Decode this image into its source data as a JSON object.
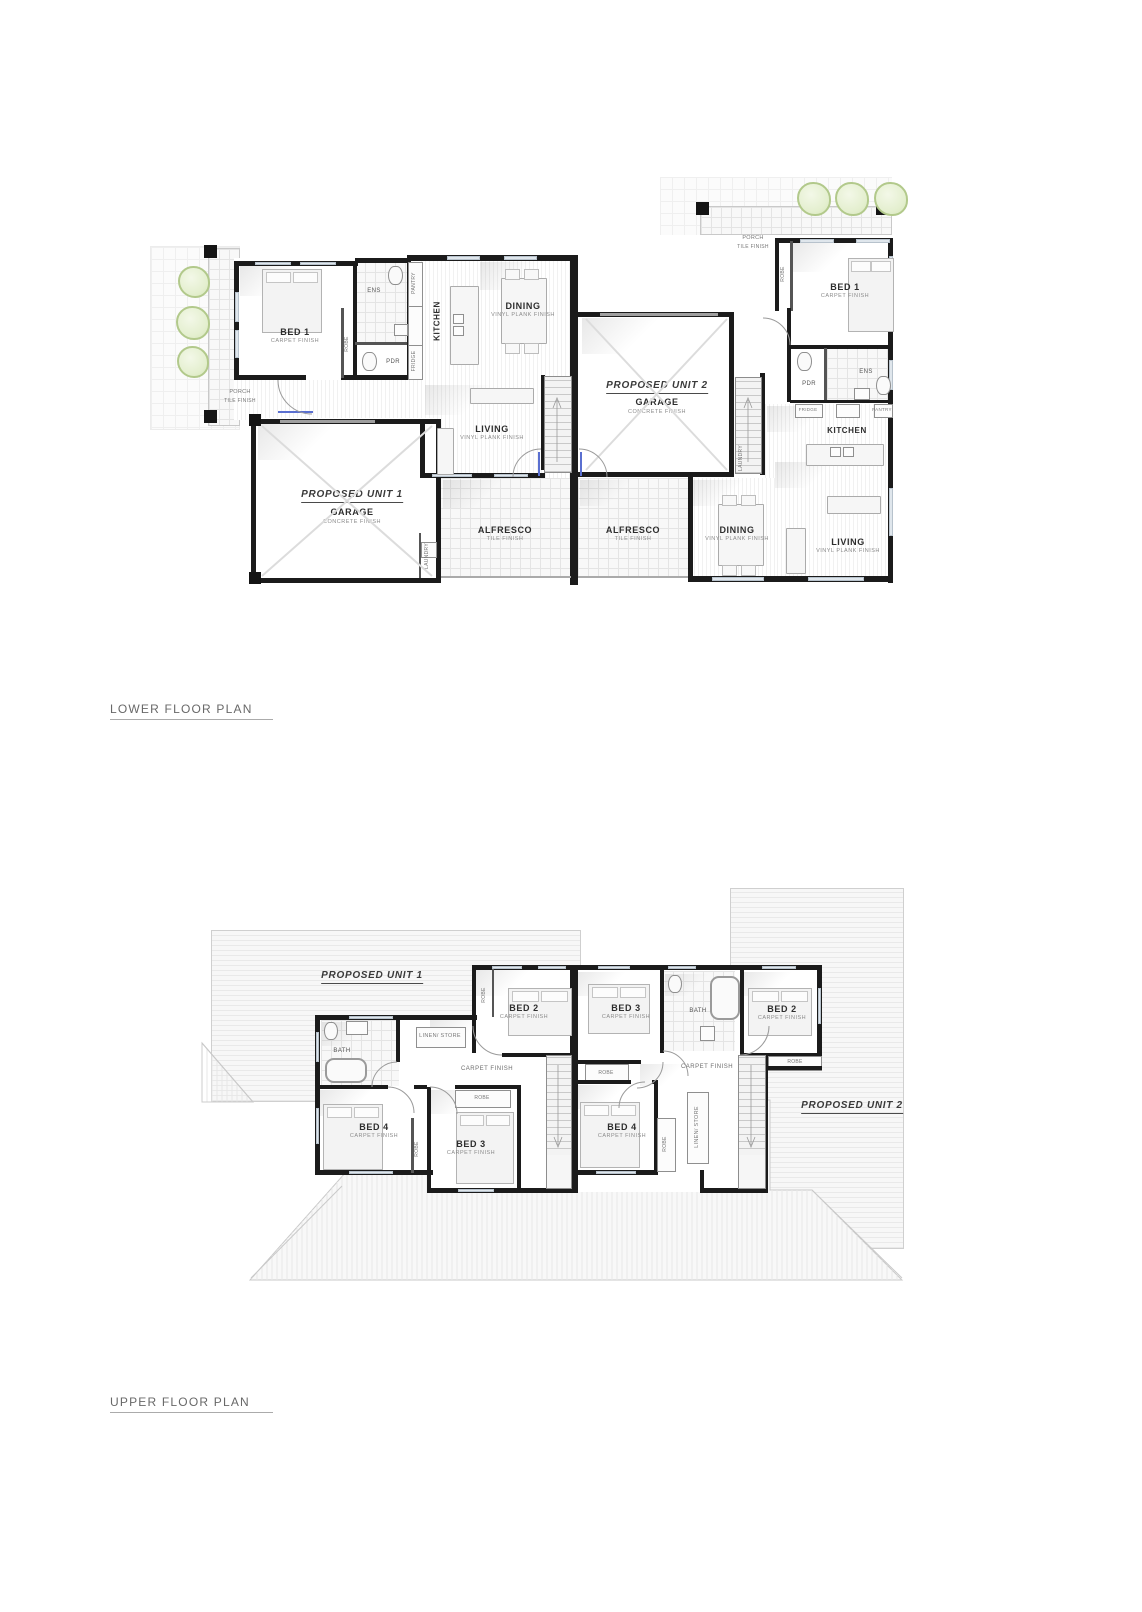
{
  "sheet": {
    "lower_title": "LOWER FLOOR PLAN",
    "upper_title": "UPPER FLOOR PLAN"
  },
  "units": {
    "unit1": "PROPOSED UNIT 1",
    "unit2": "PROPOSED UNIT 2"
  },
  "rooms": {
    "bed1": "BED 1",
    "bed2": "BED 2",
    "bed3": "BED 3",
    "bed4": "BED 4",
    "kitchen": "KITCHEN",
    "dining": "DINING",
    "living": "LIVING",
    "garage": "GARAGE",
    "alfresco": "ALFRESCO",
    "porch": "PORCH",
    "bath": "BATH",
    "ens": "ENS",
    "pdr": "PDR",
    "laundry": "LAUNDRY",
    "robe": "ROBE",
    "pantry": "PANTRY",
    "fridge": "FRIDGE",
    "linen_store": "LINEN/ STORE"
  },
  "finishes": {
    "carpet": "CARPET FINISH",
    "vinyl": "VINYL PLANK FINISH",
    "tile": "TILE FINISH",
    "concrete": "CONCRETE FINISH"
  },
  "colors": {
    "wall": "#1b1b1b",
    "window": "#dfe6ec",
    "door_threshold": "#5a6fd0",
    "tree_fill": "#e4efcf",
    "tree_outline": "#b2c98b",
    "roof_hatch": "#e9e9e9"
  }
}
